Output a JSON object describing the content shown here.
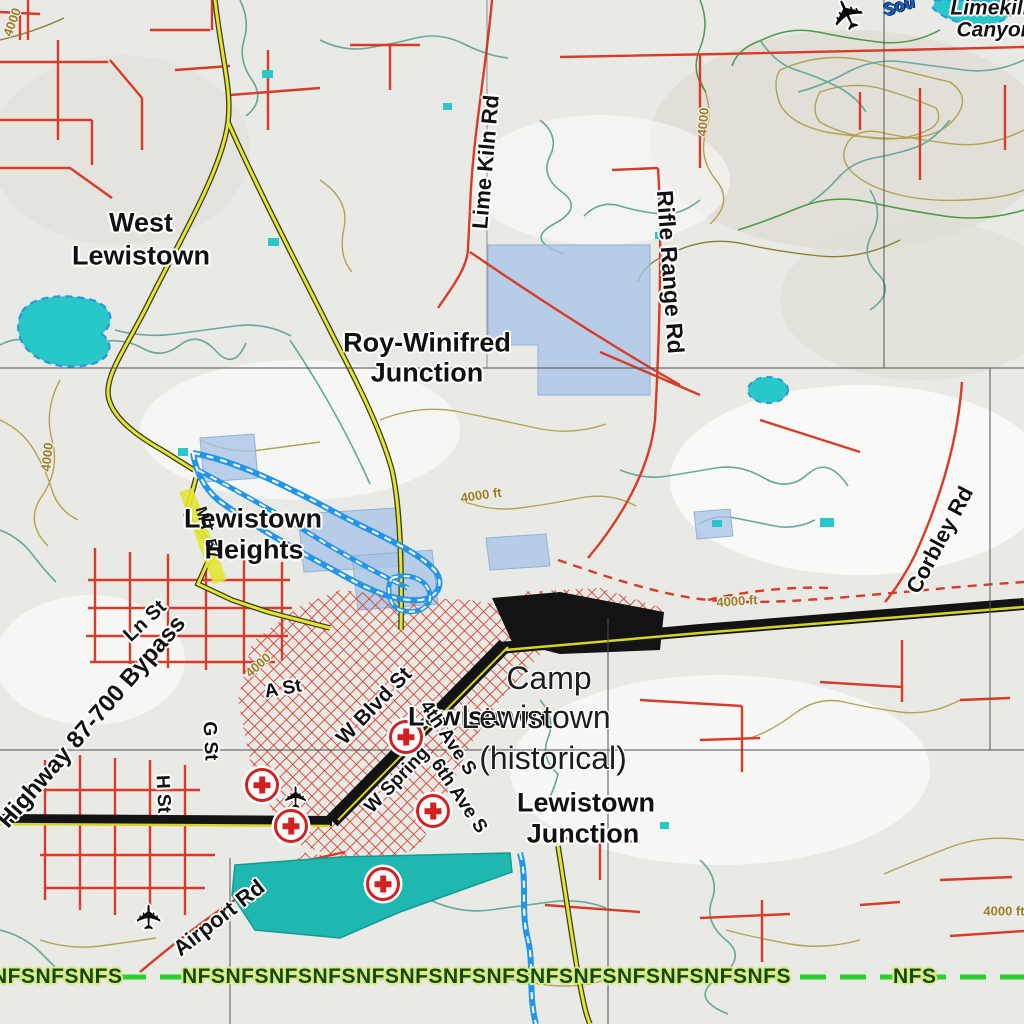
{
  "map_title": "Lewistown area topographic map",
  "place_labels": [
    {
      "id": "west-lewistown-line1",
      "text": "West"
    },
    {
      "id": "west-lewistown-line2",
      "text": "Lewistown"
    },
    {
      "id": "roy-winifred-line1",
      "text": "Roy-Winifred"
    },
    {
      "id": "roy-winifred-line2",
      "text": "Junction"
    },
    {
      "id": "lewistown-heights-line1",
      "text": "Lewistown"
    },
    {
      "id": "lewistown-heights-line2",
      "text": "Heights"
    },
    {
      "id": "lewistown-junction-line1",
      "text": "Lewistown"
    },
    {
      "id": "lewistown-junction-line2",
      "text": "Junction"
    },
    {
      "id": "lewistown-city",
      "text": "Lewistown"
    }
  ],
  "historic_labels": [
    {
      "text": "Camp"
    },
    {
      "text": "Lewistown"
    },
    {
      "text": "(historical)"
    }
  ],
  "road_labels": [
    {
      "text": "Lime Kiln Rd"
    },
    {
      "text": "Rifle Range Rd"
    },
    {
      "text": "Corbley Rd"
    },
    {
      "text": "Highway 87-700 Bypass"
    },
    {
      "text": "Ln St"
    },
    {
      "text": "A St"
    },
    {
      "text": "G St"
    },
    {
      "text": "H St"
    },
    {
      "text": "W Blvd St"
    },
    {
      "text": "4th Ave S"
    },
    {
      "text": "6th Ave S"
    },
    {
      "text": "W Spring"
    },
    {
      "text": "Airport Rd"
    },
    {
      "text": "MT 57"
    }
  ],
  "elevation_labels": [
    {
      "text": "4000 ft"
    },
    {
      "text": "4000 ft"
    },
    {
      "text": "4000 ft"
    },
    {
      "text": "4000"
    },
    {
      "text": "4000"
    },
    {
      "text": "4000"
    },
    {
      "text": "4000"
    }
  ],
  "water_labels": [
    {
      "text": "Sou"
    }
  ],
  "corner_labels": [
    {
      "text": "Limekiln"
    },
    {
      "text": "Canyon"
    }
  ],
  "boundary": {
    "pattern_left": "NFSNFSNFS",
    "pattern_middle": "NFSNFSNFSNFSNFSNFSNFSNFSNFSNFSNFSNFSNFSNFS",
    "pattern_right": "NFS"
  },
  "icons": {
    "airplane_count": 3,
    "medical_cross_count": 5
  },
  "colors": {
    "background": "#e9e9e6",
    "road_red": "#d83c28",
    "highway_black": "#131313",
    "highway_yellow": "#d6d620",
    "state_road_yellow": "#e4e432",
    "water_cyan": "#29c8c8",
    "overlay_blue": "#a9c4e6",
    "canal_blue": "#2196e8",
    "contour_tan": "#b2a352",
    "stream_teal": "#66a89a",
    "boundary_green": "#2bd22b",
    "nfs_text_green": "#15480f",
    "elevation_tan": "#9b7d28",
    "medical_red": "#d32020"
  }
}
